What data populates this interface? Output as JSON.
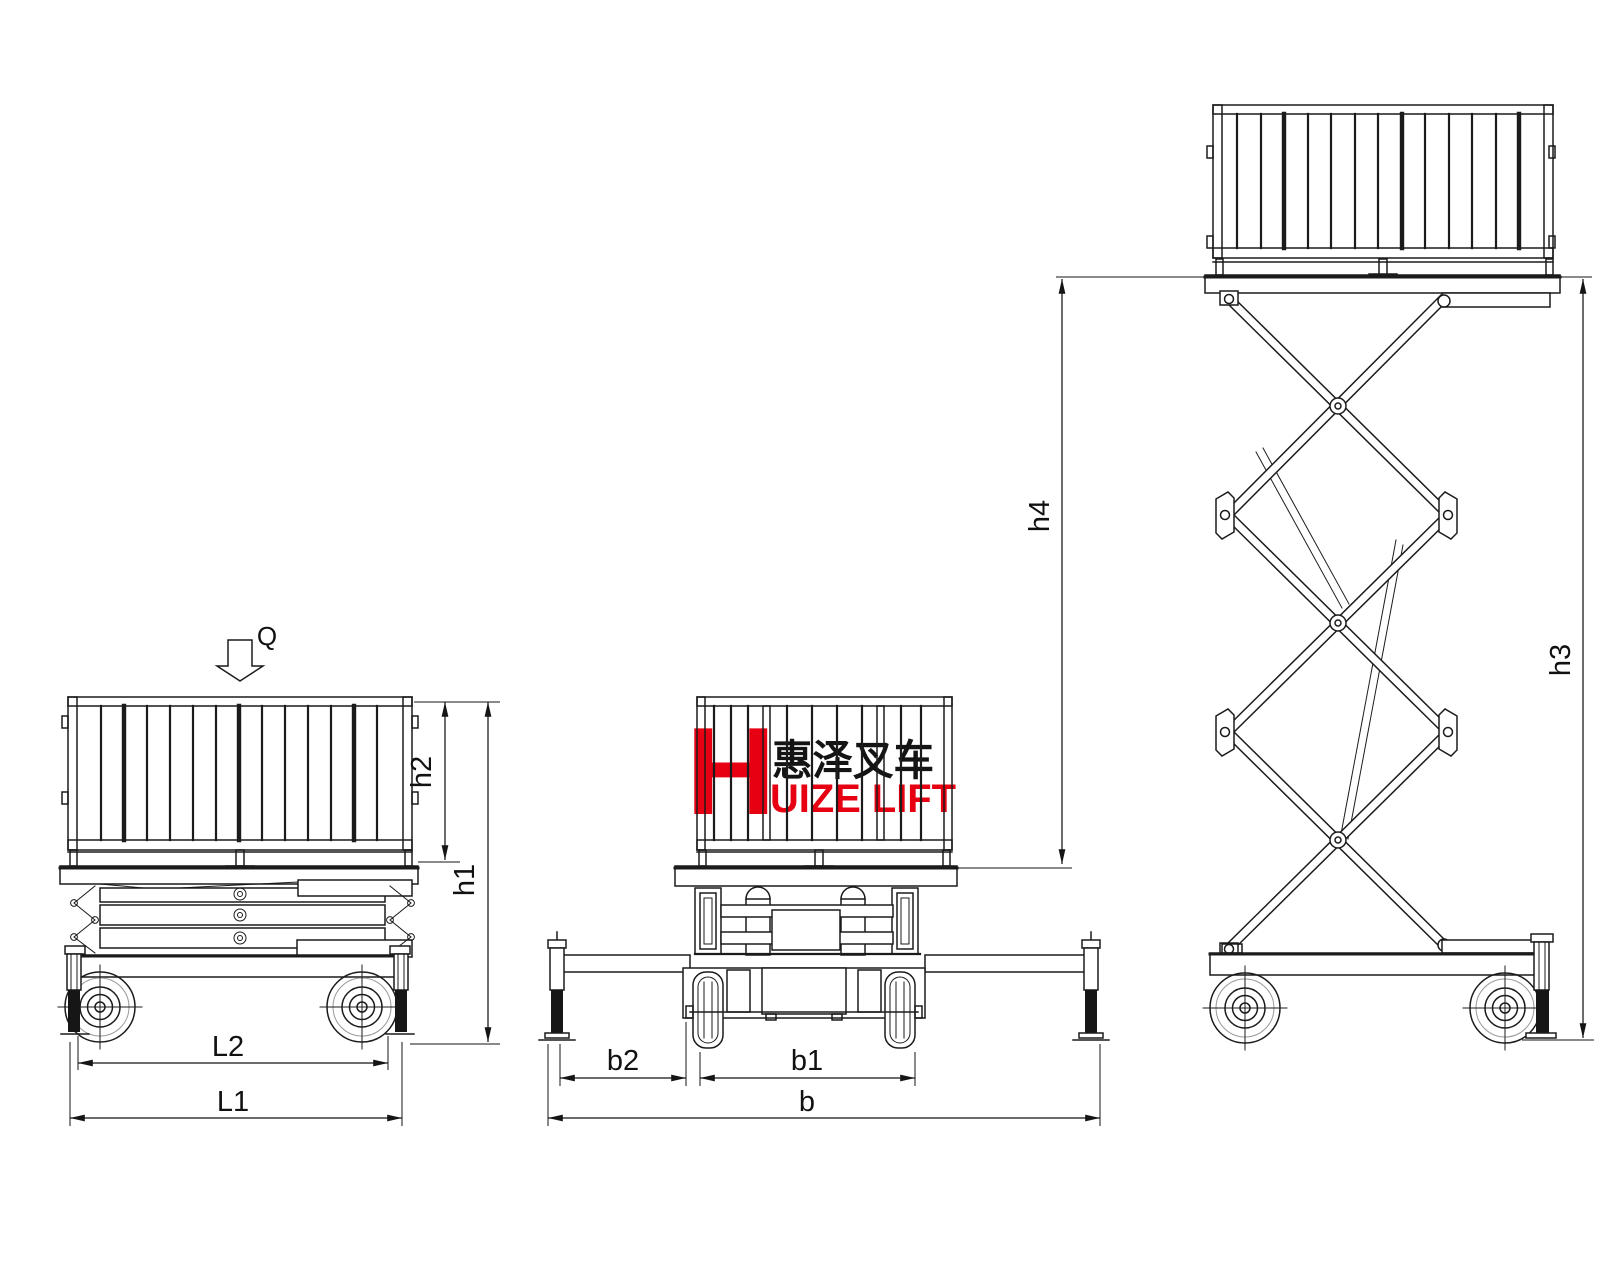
{
  "drawing": {
    "logo": {
      "initial": "H",
      "cjk": "惠泽叉车",
      "latin": "UIZE LIFT"
    },
    "dimensions": {
      "load": "Q",
      "h1": "h1",
      "h2": "h2",
      "h3": "h3",
      "h4": "h4",
      "L1": "L1",
      "L2": "L2",
      "b": "b",
      "b1": "b1",
      "b2": "b2"
    },
    "colors": {
      "line": "#1b1b1b",
      "logo_red": "#e60012"
    }
  }
}
